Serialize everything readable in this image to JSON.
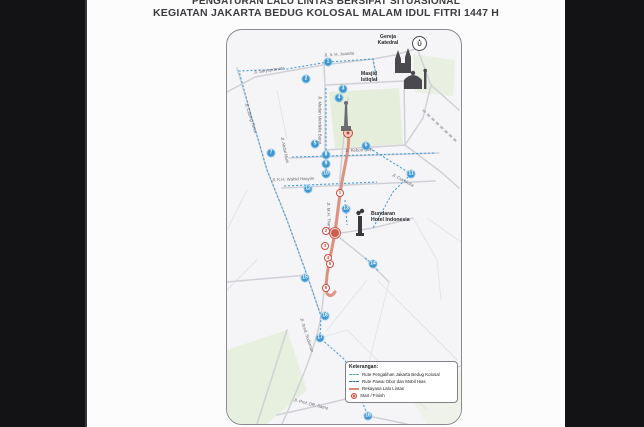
{
  "title": {
    "line1": "PENGATURAN LALU LINTAS BERSIFAT SITUASIONAL",
    "line2": "KEGIATAN JAKARTA BEDUG KOLOSAL MALAM IDUL FITRI 1447 H"
  },
  "map": {
    "compass_label": "U",
    "landmarks": {
      "katedral": "Gereja\nKatedral",
      "istiqlal": "Masjid\nIstiqlal",
      "bundaran_hi": "Bundaran\nHotel Indonesia"
    },
    "street_labels": [
      {
        "text": "Jl. Ir. H. Juanda",
        "x": 112,
        "y": 24,
        "rot": -4
      },
      {
        "text": "Jl. Suryopranoto",
        "x": 42,
        "y": 40,
        "rot": -8
      },
      {
        "text": "Jl. Cideng Timur",
        "x": 24,
        "y": 88,
        "rot": 72
      },
      {
        "text": "Jl. Abdul Muis",
        "x": 58,
        "y": 120,
        "rot": 78
      },
      {
        "text": "Jl. Medan Merdeka Barat",
        "x": 93,
        "y": 90,
        "rot": 90
      },
      {
        "text": "Jl. Kebon Sirih",
        "x": 132,
        "y": 120,
        "rot": -2
      },
      {
        "text": "Jl. K.H. Wahid Hasyim",
        "x": 66,
        "y": 149,
        "rot": -2
      },
      {
        "text": "Jl. M.H. Thamrin",
        "x": 102,
        "y": 188,
        "rot": 88
      },
      {
        "text": "Jl. Cut Mutia",
        "x": 176,
        "y": 150,
        "rot": 28
      },
      {
        "text": "Jl. Jend. Sudirman",
        "x": 80,
        "y": 305,
        "rot": 72
      },
      {
        "text": "Jl. Prof. DR. Satrio",
        "x": 84,
        "y": 374,
        "rot": 14
      }
    ],
    "markers": {
      "blue": [
        {
          "n": "1",
          "x": 101,
          "y": 32
        },
        {
          "n": "2",
          "x": 79,
          "y": 49
        },
        {
          "n": "3",
          "x": 116,
          "y": 59
        },
        {
          "n": "4",
          "x": 112,
          "y": 68
        },
        {
          "n": "5",
          "x": 88,
          "y": 114
        },
        {
          "n": "6",
          "x": 139,
          "y": 116
        },
        {
          "n": "7",
          "x": 44,
          "y": 123
        },
        {
          "n": "8",
          "x": 99,
          "y": 125
        },
        {
          "n": "9",
          "x": 99,
          "y": 134
        },
        {
          "n": "10",
          "x": 99,
          "y": 144
        },
        {
          "n": "11",
          "x": 184,
          "y": 144
        },
        {
          "n": "12",
          "x": 81,
          "y": 159
        },
        {
          "n": "13",
          "x": 119,
          "y": 179
        },
        {
          "n": "14",
          "x": 146,
          "y": 234
        },
        {
          "n": "15",
          "x": 78,
          "y": 248
        },
        {
          "n": "16",
          "x": 98,
          "y": 286
        },
        {
          "n": "17",
          "x": 93,
          "y": 308
        },
        {
          "n": "18",
          "x": 141,
          "y": 386
        }
      ],
      "red": [
        {
          "n": "1",
          "x": 113,
          "y": 163
        },
        {
          "n": "2",
          "x": 99,
          "y": 201
        },
        {
          "n": "3",
          "x": 98,
          "y": 216
        },
        {
          "n": "4",
          "x": 101,
          "y": 228
        },
        {
          "n": "5",
          "x": 103,
          "y": 234
        },
        {
          "n": "6",
          "x": 99,
          "y": 258
        }
      ],
      "start": {
        "x": 121,
        "y": 103
      },
      "roundabout": {
        "x": 108,
        "y": 203
      }
    }
  },
  "legend": {
    "title": "Keterangan:",
    "items": [
      {
        "label": "Rute Pengalihan Jakarta Bedug Kolosal",
        "swatch": "dash-blue"
      },
      {
        "label": "Rute Pawai Obor dan Mobil Hias",
        "swatch": "dash-navy"
      },
      {
        "label": "Rekayasa Lalu Lintas",
        "swatch": "line-salmon"
      },
      {
        "label": "Start / Finish",
        "swatch": "circle-red"
      }
    ]
  },
  "colors": {
    "route_parade": "#d98a76",
    "route_diversion": "#4f9fd4",
    "marker_blue": "#3e97cf",
    "marker_red": "#cd4a3d",
    "park_green": "#e4eeda",
    "background": "#131315"
  }
}
